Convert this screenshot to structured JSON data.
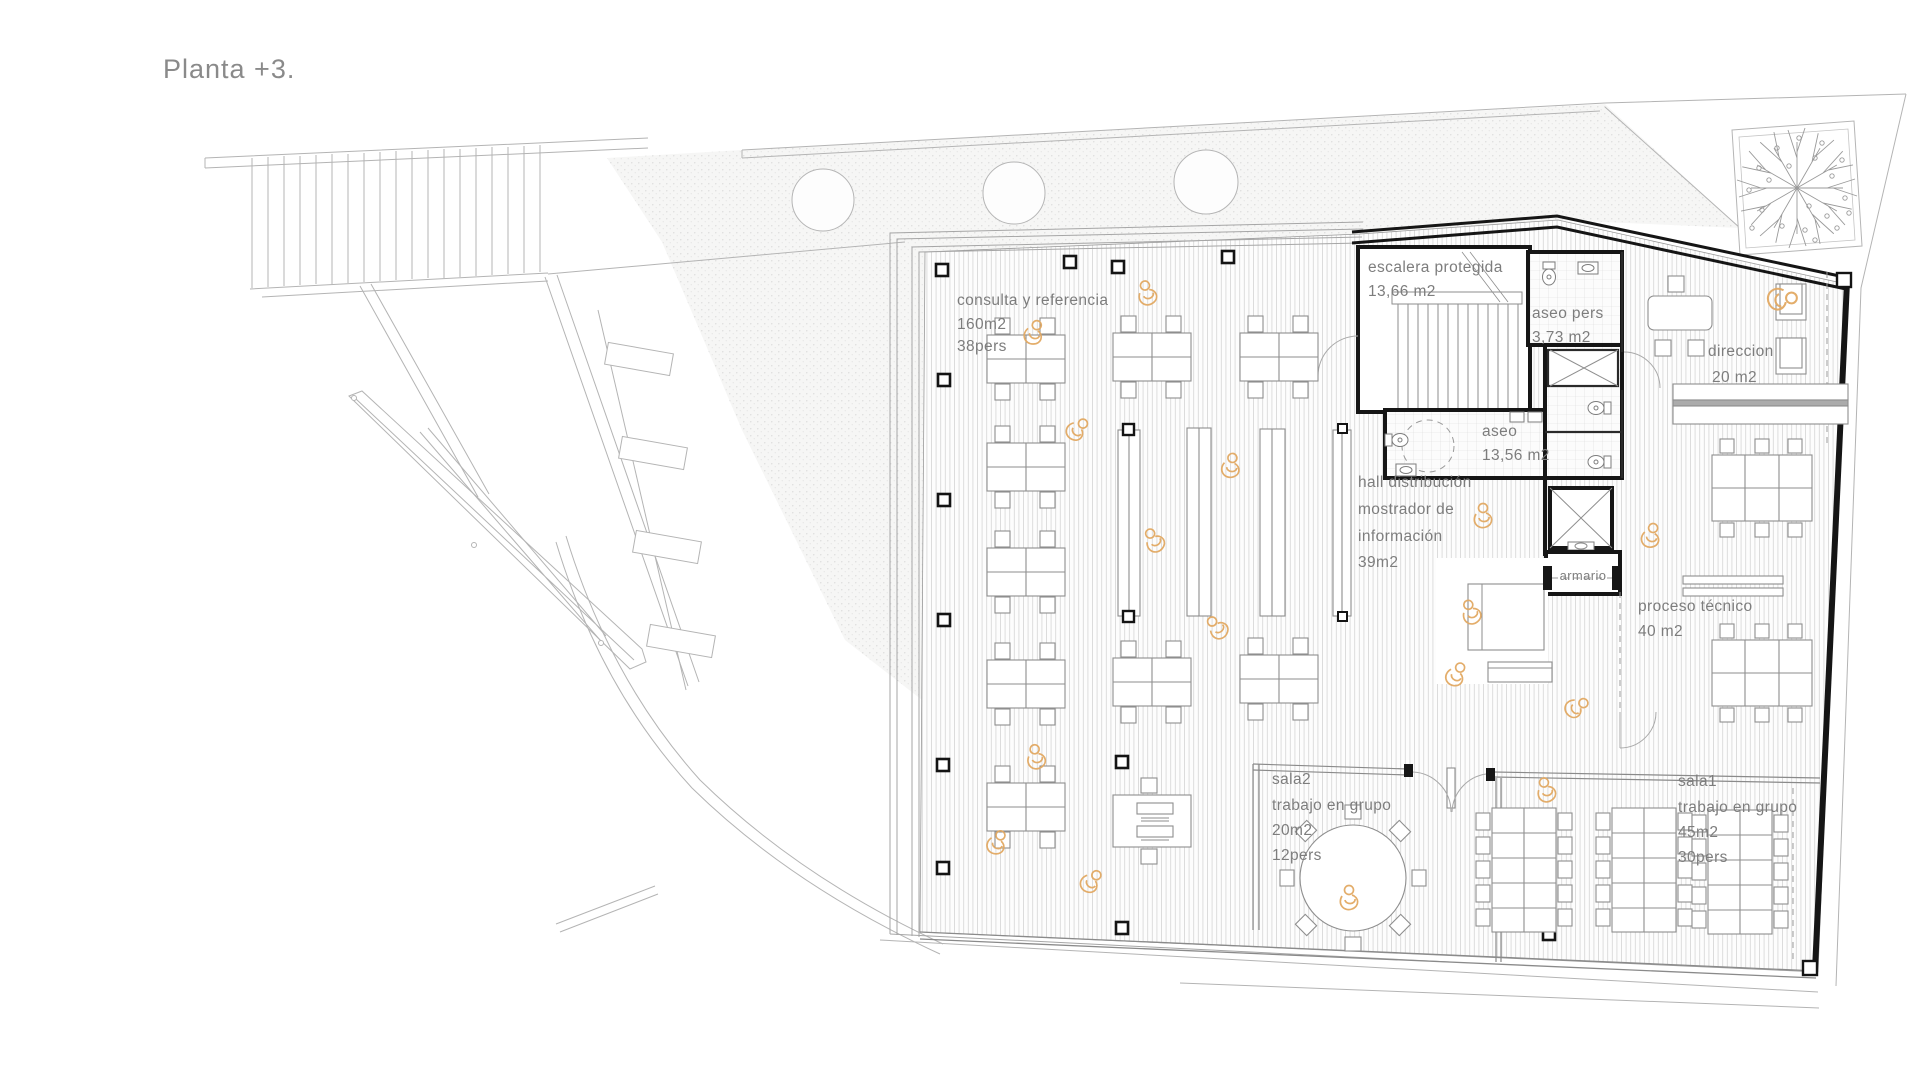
{
  "title": "Planta +3.",
  "colors": {
    "paper": "#ffffff",
    "label_text": "#7d7d7d",
    "wall": "#161616",
    "site_lines": "#b4b4b4",
    "floor_hatch": "#d2d2d2",
    "person_accent": "#e2a963"
  },
  "rooms": {
    "consulta": {
      "name": "consulta y referencia",
      "area": "160m2",
      "capacity": "38pers"
    },
    "escalera": {
      "name": "escalera protegida",
      "area": "13,66 m2"
    },
    "aseo_pers": {
      "name": "aseo pers",
      "area": "3,73 m2"
    },
    "aseo": {
      "name": "aseo",
      "area": "13,56 m2"
    },
    "hall": {
      "name": "hall distribución",
      "line2": "mostrador de",
      "line3": "información",
      "area": "39m2"
    },
    "armario": {
      "name": "armario"
    },
    "direccion": {
      "name": "direccion",
      "area": "20 m2"
    },
    "proceso": {
      "name": "proceso técnico",
      "area": "40 m2"
    },
    "sala2": {
      "name": "sala2",
      "type": "trabajo en grupo",
      "area": "20m2",
      "capacity": "12pers"
    },
    "sala1": {
      "name": "sala1",
      "type": "trabajo en grupo",
      "area": "45m2",
      "capacity": "30pers"
    }
  }
}
